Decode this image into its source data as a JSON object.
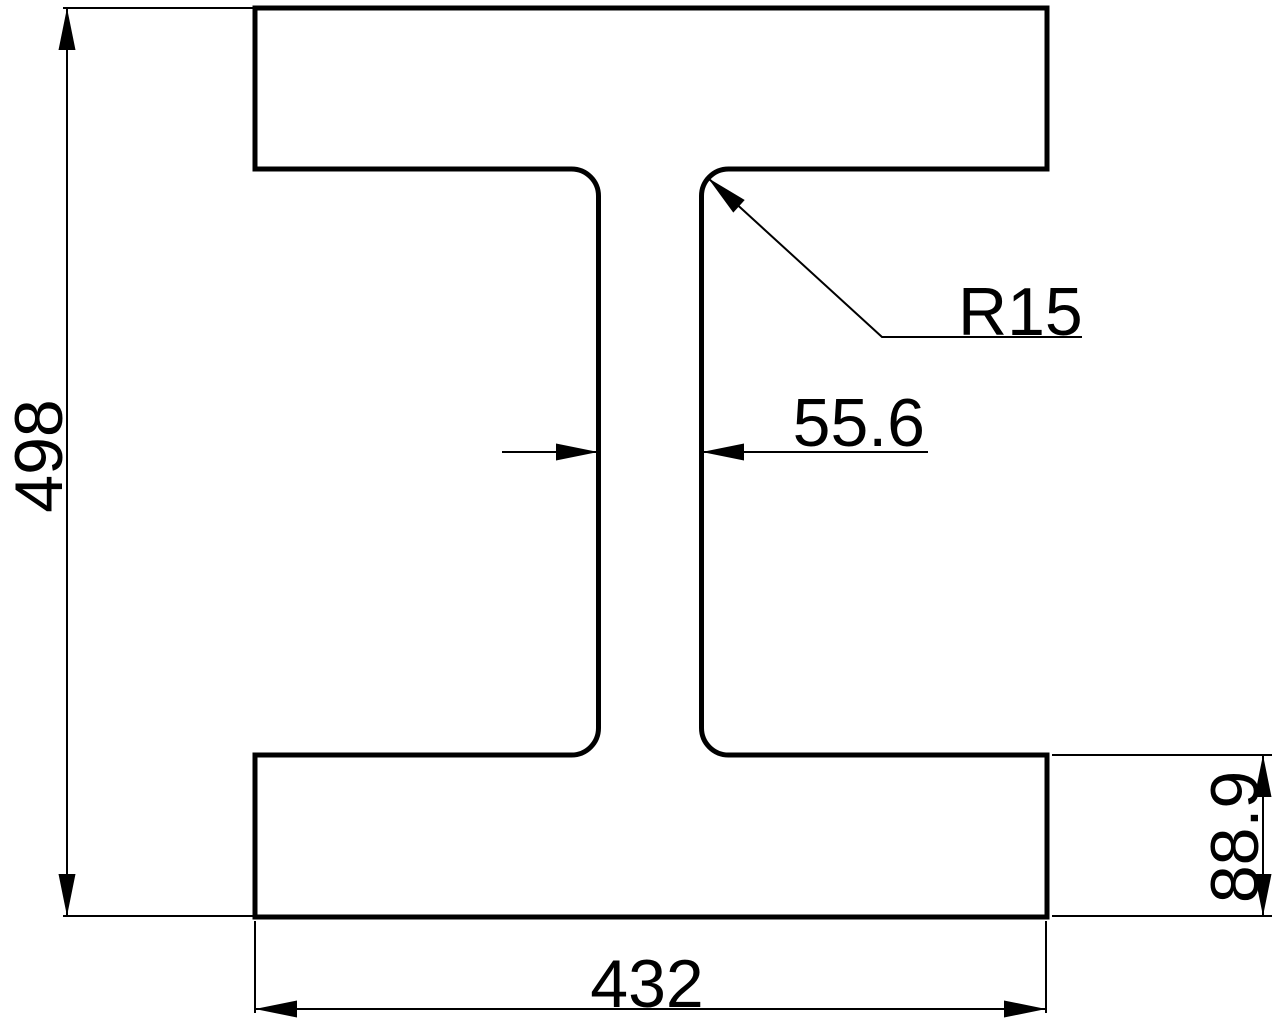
{
  "drawing": {
    "title": "I-beam cross-section technical drawing",
    "labels": {
      "overall_height": "498",
      "fillet_radius": "R15",
      "web_thickness": "55.6",
      "flange_thickness": "88.9",
      "flange_width": "432"
    },
    "colors": {
      "line": "#000000",
      "background": "#ffffff"
    }
  }
}
